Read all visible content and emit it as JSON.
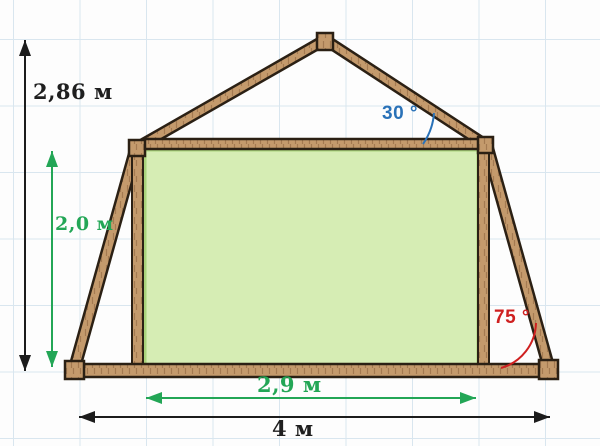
{
  "diagram": {
    "labels": {
      "total_height": "2,86 м",
      "room_height": "2,0 м",
      "room_width": "2,9 м",
      "total_width": "4 м",
      "angle_top": "30 °",
      "angle_side": "75 °"
    },
    "colors": {
      "background": "#fdfdfd",
      "grid_line": "#d9e6ef",
      "wood_fill": "#c49a6c",
      "wood_outline": "#2b2014",
      "room_fill": "#d6edb4",
      "room_border": "#a9d37b",
      "dim_black": "#1c1c1c",
      "dim_green": "#23a656",
      "angle_blue": "#2a72b8",
      "angle_red": "#cf2020"
    }
  }
}
